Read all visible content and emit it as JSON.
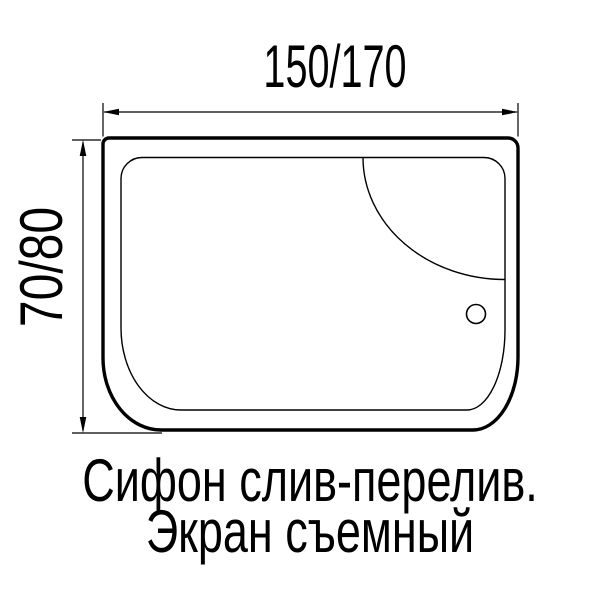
{
  "figure": {
    "type": "bathtub-top-view-dimension-drawing",
    "top_dimension_label": "150/170",
    "side_dimension_label": "70/80",
    "caption": {
      "line1": "Сифон слив-перелив.",
      "line2": "Экран съемный"
    },
    "features": {
      "headrest_arc": "quarter-ellipse-top-right",
      "drain_hole": "small-circle-right-side"
    },
    "colors": {
      "ink": "#000000",
      "background": "#ffffff"
    }
  }
}
